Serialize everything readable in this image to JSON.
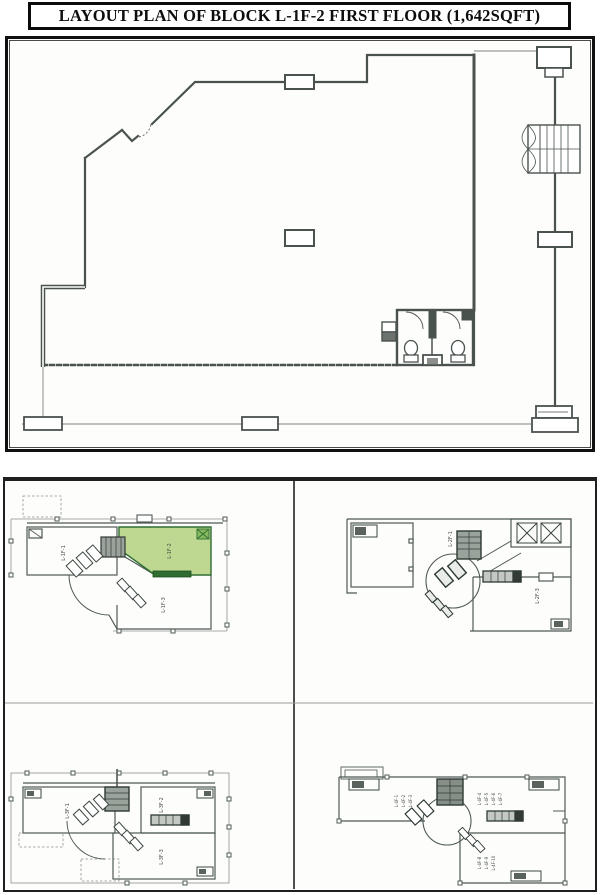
{
  "title": "LAYOUT PLAN OF BLOCK L-1F-2 FIRST FLOOR (1,642SQFT)",
  "colors": {
    "highlight_fill": "#b7d486",
    "highlight_stroke": "#2f6d33",
    "highlight_bar": "#2f6d33",
    "line": "#4a524e"
  },
  "key_plans": {
    "plan_a": {
      "unit_left": "L-1F-1",
      "unit_highlight": "L-1F-2",
      "unit_bottom": "L-1F-3"
    },
    "plan_b": {
      "unit_core": "L-2F-1",
      "unit_right": "L-2F-3"
    },
    "plan_c": {
      "unit_left": "L-3F-1",
      "unit_right": "L-3F-2",
      "unit_bottom": "L-3F-3"
    },
    "plan_d": {
      "room_left": [
        "L-4F-1",
        "L-4F-2",
        "L-4F-3"
      ],
      "room_right": [
        "L-4F-4",
        "L-4F-5",
        "L-4F-6",
        "L-4F-7"
      ],
      "room_bottom": [
        "L-4F-8",
        "L-4F-9",
        "L-4F-10"
      ]
    }
  }
}
